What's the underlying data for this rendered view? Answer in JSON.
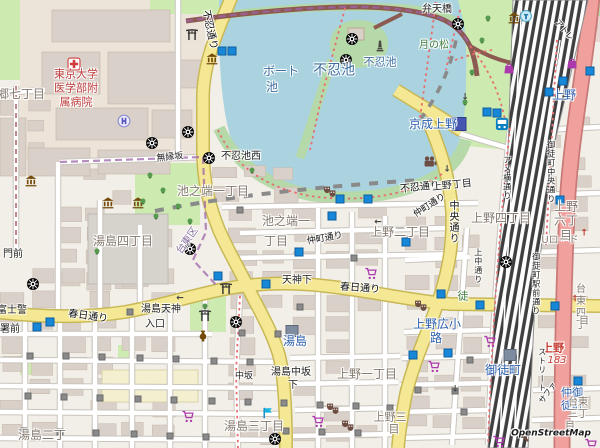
{
  "attribution": {
    "label": "OpenStreetMap"
  },
  "map": {
    "colors": {
      "background": "#f2efe9",
      "water": "#aad3df",
      "park": "#cdebb0",
      "green_dense": "#b5d9a8",
      "building": "#d9d0c9",
      "secondary_road": "#f4e894",
      "trunk_road": "#f0a19e",
      "railway": "#3f3f3f",
      "station_blue": "#2b5fad",
      "subway_entrance_blue": "#1787d8",
      "boundary_purple": "#9e66a8",
      "poi_brown": "#734a08",
      "shop_magenta": "#ac39ac",
      "hospital_red": "#bd3b3b"
    },
    "labels": [
      {
        "t": "東京大学\n医学部附\n属病院",
        "x": 76,
        "y": 88,
        "c": "hospital"
      },
      {
        "t": "郷七丁目",
        "x": 21,
        "y": 94,
        "c": "area",
        "s": 12
      },
      {
        "t": "無縁坂",
        "x": 170,
        "y": 158,
        "c": "name",
        "s": 9,
        "r": -6
      },
      {
        "t": "不忍池西",
        "x": 241,
        "y": 157,
        "c": "name"
      },
      {
        "t": "池之端一丁目",
        "x": 213,
        "y": 191,
        "c": "area",
        "s": 12
      },
      {
        "t": "池之端一",
        "x": 286,
        "y": 221,
        "c": "area",
        "s": 12
      },
      {
        "t": "丁目",
        "x": 276,
        "y": 241,
        "c": "area",
        "s": 12
      },
      {
        "t": "台東区",
        "x": 188,
        "y": 241,
        "c": "admin",
        "r": -55
      },
      {
        "t": "湯島四丁目",
        "x": 123,
        "y": 241,
        "c": "area",
        "s": 12
      },
      {
        "t": "門前",
        "x": 13,
        "y": 255,
        "c": "name"
      },
      {
        "t": "上野二丁目",
        "x": 400,
        "y": 232,
        "c": "area",
        "s": 12
      },
      {
        "t": "上野四丁目",
        "x": 501,
        "y": 218,
        "c": "area",
        "s": 12
      },
      {
        "t": "上野六丁目",
        "x": 566,
        "y": 221,
        "c": "area",
        "s": 12
      },
      {
        "t": "Uロード",
        "x": 560,
        "y": 241,
        "c": "area"
      },
      {
        "t": "台東四丁",
        "x": 581,
        "y": 308,
        "c": "area"
      },
      {
        "t": "目",
        "x": 584,
        "y": 322,
        "c": "area"
      },
      {
        "t": "上野",
        "x": 553,
        "y": 348,
        "c": "red",
        "s": 11
      },
      {
        "t": "183",
        "x": 557,
        "y": 361,
        "c": "route"
      },
      {
        "t": "仲御徒町",
        "x": 572,
        "y": 399,
        "c": "station",
        "s": 11
      },
      {
        "t": "台東三丁",
        "x": 578,
        "y": 409,
        "c": "area"
      },
      {
        "t": "目",
        "x": 570,
        "y": 427,
        "c": "area"
      },
      {
        "t": "御徒町",
        "x": 503,
        "y": 370,
        "c": "station",
        "s": 12
      },
      {
        "t": "上野広小",
        "x": 437,
        "y": 324,
        "c": "station",
        "s": 12
      },
      {
        "t": "路",
        "x": 436,
        "y": 338,
        "c": "station",
        "s": 12
      },
      {
        "t": "徒",
        "x": 463,
        "y": 296,
        "c": "green",
        "s": 11
      },
      {
        "t": "湯島",
        "x": 295,
        "y": 341,
        "c": "station",
        "s": 12
      },
      {
        "t": "上野一丁目",
        "x": 367,
        "y": 374,
        "c": "area",
        "s": 12
      },
      {
        "t": "上野三",
        "x": 390,
        "y": 417,
        "c": "area",
        "s": 11
      },
      {
        "t": "目",
        "x": 394,
        "y": 429,
        "c": "area",
        "s": 11
      },
      {
        "t": "湯島三丁目",
        "x": 254,
        "y": 426,
        "c": "area",
        "s": 12
      },
      {
        "t": "湯島中坂",
        "x": 291,
        "y": 373,
        "c": "name"
      },
      {
        "t": "下",
        "x": 293,
        "y": 386,
        "c": "name"
      },
      {
        "t": "中坂",
        "x": 244,
        "y": 377,
        "c": "name",
        "s": 9
      },
      {
        "t": "湯島二丁",
        "x": 42,
        "y": 435,
        "c": "area",
        "s": 12
      },
      {
        "t": "湯島天神",
        "x": 161,
        "y": 310,
        "c": "name"
      },
      {
        "t": "入口",
        "x": 155,
        "y": 325,
        "c": "name"
      },
      {
        "t": "富士警",
        "x": 12,
        "y": 311,
        "c": "name"
      },
      {
        "t": "署前",
        "x": 10,
        "y": 330,
        "c": "name"
      },
      {
        "t": "春日通り",
        "x": 88,
        "y": 317,
        "c": "road",
        "s": 10,
        "r": 8
      },
      {
        "t": "春日通り",
        "x": 360,
        "y": 289,
        "c": "road",
        "s": 10,
        "r": 4
      },
      {
        "t": "天神下",
        "x": 297,
        "y": 281,
        "c": "name"
      },
      {
        "t": "仲町通り",
        "x": 325,
        "y": 239,
        "c": "road",
        "r": -10
      },
      {
        "t": "仲町通り",
        "x": 430,
        "y": 206,
        "c": "road",
        "r": -33
      },
      {
        "t": "不忍通り",
        "x": 209,
        "y": 30,
        "c": "road",
        "s": 10,
        "r": 78
      },
      {
        "t": "不忍通り",
        "x": 420,
        "y": 188,
        "c": "road",
        "s": 10,
        "r": -6
      },
      {
        "t": "上野丁目",
        "x": 452,
        "y": 186,
        "c": "name",
        "r": -6
      },
      {
        "t": "中央通り",
        "x": 452,
        "y": 222,
        "c": "road",
        "s": 10,
        "v": true
      },
      {
        "t": "上中通り",
        "x": 478,
        "y": 266,
        "c": "name",
        "s": 8,
        "v": true
      },
      {
        "t": "アメ横通り",
        "x": 507,
        "y": 178,
        "c": "name",
        "s": 8,
        "v": true
      },
      {
        "t": "御徒町中央通り",
        "x": 551,
        "y": 172,
        "c": "name",
        "s": 8,
        "v": true
      },
      {
        "t": "御徒町駅前通り",
        "x": 536,
        "y": 284,
        "c": "name",
        "s": 8,
        "v": true
      },
      {
        "t": "ストリート",
        "x": 542,
        "y": 370,
        "c": "name",
        "s": 8,
        "v": true
      },
      {
        "t": "サファ",
        "x": 548,
        "y": 393,
        "c": "name",
        "s": 8,
        "r": -55
      },
      {
        "t": "アトレ",
        "x": 564,
        "y": 30,
        "c": "name",
        "s": 8,
        "r": 50
      },
      {
        "t": "月の松",
        "x": 434,
        "y": 46,
        "c": "green",
        "s": 10
      },
      {
        "t": "弁天橋",
        "x": 437,
        "y": 10,
        "c": "name"
      },
      {
        "t": "不忍池",
        "x": 334,
        "y": 71,
        "c": "water",
        "s": 14
      },
      {
        "t": "不忍池",
        "x": 380,
        "y": 62,
        "c": "water",
        "s": 11
      },
      {
        "t": "ボート",
        "x": 281,
        "y": 71,
        "c": "water",
        "s": 12
      },
      {
        "t": "池",
        "x": 272,
        "y": 87,
        "c": "water",
        "s": 12
      },
      {
        "t": "京成上野",
        "x": 433,
        "y": 124,
        "c": "station",
        "s": 12
      },
      {
        "t": "上野",
        "x": 564,
        "y": 95,
        "c": "station",
        "s": 12
      }
    ],
    "icons": [
      {
        "t": "hospital",
        "x": 74,
        "y": 62
      },
      {
        "t": "helipad",
        "x": 124,
        "y": 119
      },
      {
        "t": "museum",
        "x": 212,
        "y": 57
      },
      {
        "t": "museum",
        "x": 514,
        "y": 16
      },
      {
        "t": "museum",
        "x": 31,
        "y": 179
      },
      {
        "t": "museum",
        "x": 108,
        "y": 201
      },
      {
        "t": "museum",
        "x": 138,
        "y": 201
      },
      {
        "t": "temple",
        "x": 188,
        "y": 130
      },
      {
        "t": "temple",
        "x": 152,
        "y": 141
      },
      {
        "t": "temple",
        "x": 352,
        "y": 37
      },
      {
        "t": "temple",
        "x": 346,
        "y": 58
      },
      {
        "t": "temple",
        "x": 209,
        "y": 156
      },
      {
        "t": "temple",
        "x": 190,
        "y": 247
      },
      {
        "t": "temple",
        "x": 33,
        "y": 282
      },
      {
        "t": "temple",
        "x": 236,
        "y": 320
      },
      {
        "t": "temple",
        "x": 275,
        "y": 437
      },
      {
        "t": "temple",
        "x": 506,
        "y": 260
      },
      {
        "t": "temple",
        "x": 458,
        "y": 22
      },
      {
        "t": "torii",
        "x": 192,
        "y": 32
      },
      {
        "t": "torii",
        "x": 226,
        "y": 286
      },
      {
        "t": "torii",
        "x": 205,
        "y": 313
      },
      {
        "t": "monument",
        "x": 380,
        "y": 44
      },
      {
        "t": "masks",
        "x": 330,
        "y": 190
      },
      {
        "t": "masks",
        "x": 333,
        "y": 407
      },
      {
        "t": "masks",
        "x": 348,
        "y": 424
      },
      {
        "t": "masks",
        "x": 421,
        "y": 304
      },
      {
        "t": "cinema",
        "x": 430,
        "y": 160
      },
      {
        "t": "bag",
        "x": 509,
        "y": 66
      },
      {
        "t": "bag",
        "x": 572,
        "y": 61
      },
      {
        "t": "cart",
        "x": 371,
        "y": 272
      },
      {
        "t": "cart",
        "x": 188,
        "y": 415
      },
      {
        "t": "cart",
        "x": 318,
        "y": 420
      },
      {
        "t": "cart",
        "x": 490,
        "y": 340
      },
      {
        "t": "cart",
        "x": 434,
        "y": 365
      },
      {
        "t": "cart",
        "x": 499,
        "y": 440
      },
      {
        "t": "cart",
        "x": 591,
        "y": 443
      },
      {
        "t": "bus",
        "x": 502,
        "y": 122
      },
      {
        "t": "vase",
        "x": 203,
        "y": 334
      },
      {
        "t": "flag",
        "x": 268,
        "y": 411
      },
      {
        "t": "fountain",
        "x": 526,
        "y": 14
      },
      {
        "t": "station-navy",
        "x": 459,
        "y": 124
      },
      {
        "t": "station-slate",
        "x": 292,
        "y": 331
      },
      {
        "t": "station-slate",
        "x": 510,
        "y": 355
      },
      {
        "t": "magnifier",
        "x": 522,
        "y": 433
      }
    ],
    "entrances": [
      [
        222,
        51
      ],
      [
        232,
        51
      ],
      [
        340,
        199
      ],
      [
        368,
        199
      ],
      [
        332,
        216
      ],
      [
        299,
        252
      ],
      [
        406,
        242
      ],
      [
        218,
        276
      ],
      [
        266,
        284
      ],
      [
        37,
        327
      ],
      [
        50,
        322
      ],
      [
        487,
        112
      ],
      [
        497,
        113
      ],
      [
        549,
        92
      ],
      [
        563,
        81
      ],
      [
        590,
        71
      ],
      [
        560,
        200
      ],
      [
        441,
        294
      ],
      [
        480,
        305
      ],
      [
        555,
        306
      ],
      [
        413,
        355
      ],
      [
        448,
        353
      ],
      [
        578,
        381
      ]
    ],
    "dots": [
      [
        30,
        356
      ],
      [
        66,
        356
      ],
      [
        102,
        357
      ],
      [
        140,
        358
      ],
      [
        176,
        359
      ],
      [
        28,
        396
      ],
      [
        64,
        397
      ],
      [
        100,
        398
      ],
      [
        138,
        399
      ],
      [
        174,
        400
      ],
      [
        24,
        431
      ],
      [
        60,
        432
      ],
      [
        96,
        433
      ],
      [
        134,
        434
      ],
      [
        170,
        436
      ],
      [
        206,
        437
      ],
      [
        214,
        361
      ],
      [
        250,
        362
      ],
      [
        212,
        401
      ],
      [
        248,
        402
      ],
      [
        284,
        403
      ],
      [
        320,
        405
      ],
      [
        356,
        406
      ],
      [
        390,
        408
      ],
      [
        286,
        431
      ],
      [
        322,
        432
      ],
      [
        358,
        433
      ],
      [
        130,
        312
      ],
      [
        166,
        309
      ],
      [
        242,
        333
      ],
      [
        278,
        334
      ],
      [
        418,
        390
      ],
      [
        455,
        391
      ],
      [
        240,
        210
      ],
      [
        354,
        258
      ],
      [
        300,
        307
      ],
      [
        470,
        360
      ],
      [
        464,
        412
      ]
    ],
    "arrows": [
      {
        "g": "←",
        "x": 180,
        "y": 299,
        "col": "#444"
      },
      {
        "g": "↓",
        "x": 447,
        "y": 170,
        "col": "#444"
      },
      {
        "g": "←",
        "x": 378,
        "y": 223,
        "col": "#444"
      },
      {
        "g": "↓",
        "x": 455,
        "y": 390,
        "col": "#444"
      },
      {
        "g": "↓",
        "x": 465,
        "y": 98,
        "col": "#444"
      },
      {
        "g": "↑",
        "x": 584,
        "y": 234,
        "col": "#c0392b"
      },
      {
        "g": "↑",
        "x": 570,
        "y": 414,
        "col": "#c0392b"
      },
      {
        "g": "↑",
        "x": 575,
        "y": 300,
        "col": "#c0392b"
      }
    ],
    "trees": [
      [
        150,
        175
      ],
      [
        163,
        190
      ],
      [
        178,
        206
      ],
      [
        143,
        201
      ],
      [
        156,
        216
      ],
      [
        190,
        221
      ],
      [
        97,
        251
      ],
      [
        482,
        40
      ],
      [
        472,
        72
      ],
      [
        465,
        102
      ],
      [
        488,
        18
      ],
      [
        252,
        170
      ],
      [
        205,
        306
      ]
    ]
  }
}
